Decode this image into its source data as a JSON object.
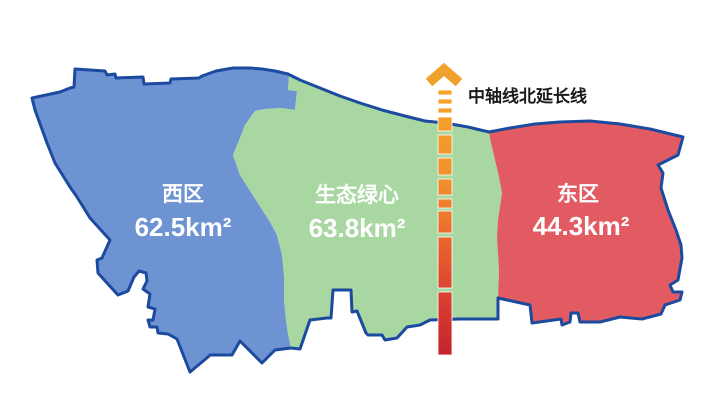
{
  "figure": {
    "background": "#FFFFFF",
    "border_color": "#1B4A9E",
    "region_label_color": "#FFFFFF"
  },
  "axis": {
    "label": "中轴线北延长线",
    "label_color": "#1A1A1A",
    "arrow_color": "#F0A22E",
    "gradient": {
      "top": "#F5A62B",
      "upper": "#F0902C",
      "middle": "#E8642E",
      "lower": "#D83C30",
      "bottom": "#C2252D"
    }
  },
  "regions": [
    {
      "name": "西区",
      "area": "62.5km²",
      "fill": "#6E93D2"
    },
    {
      "name": "生态绿心",
      "area": "63.8km²",
      "fill": "#A9D7A2"
    },
    {
      "name": "东区",
      "area": "44.3km²",
      "fill": "#E25B63"
    }
  ]
}
